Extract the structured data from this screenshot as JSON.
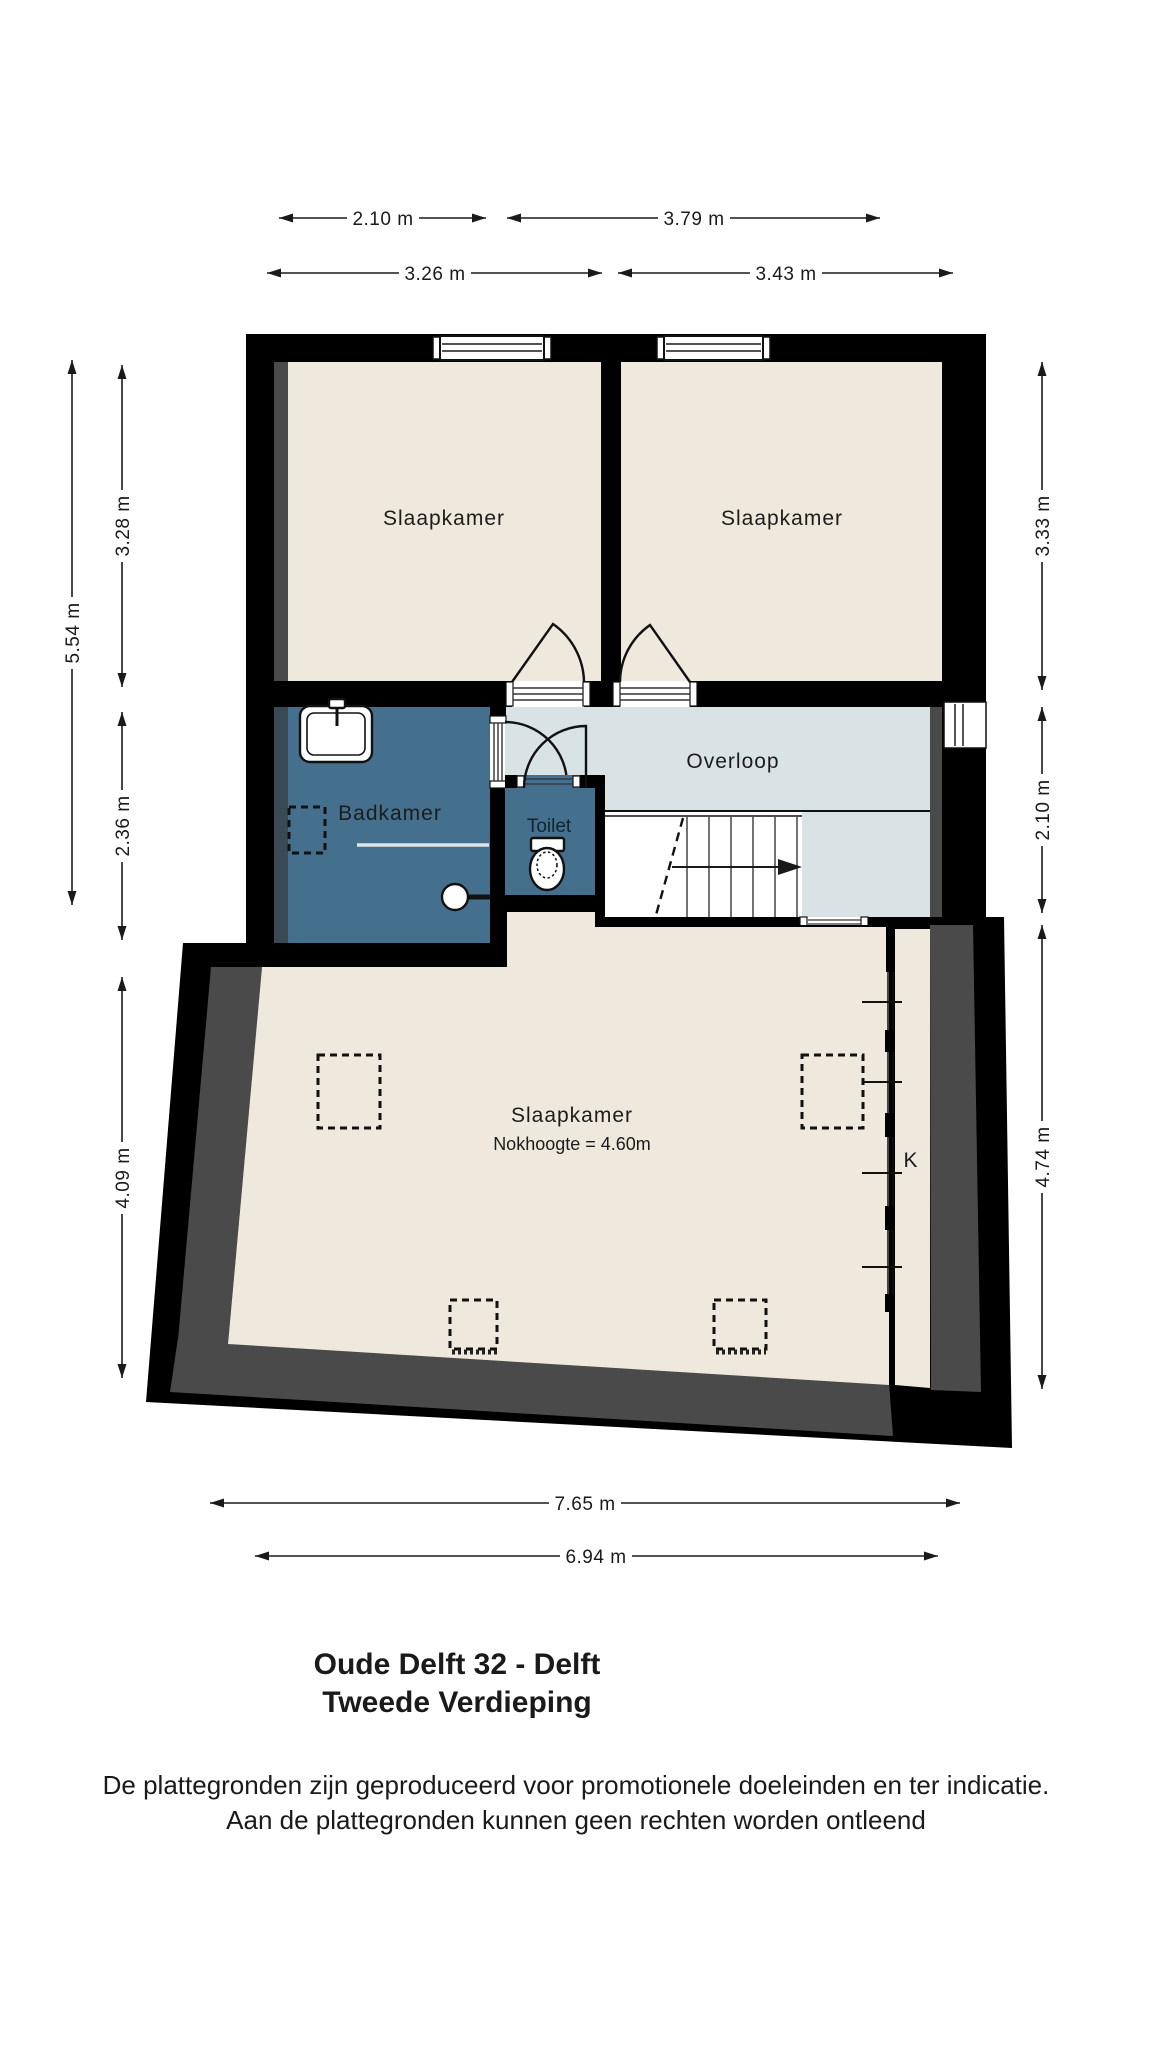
{
  "plan": {
    "rooms": {
      "bedroom_top_left": {
        "label": "Slaapkamer"
      },
      "bedroom_top_right": {
        "label": "Slaapkamer"
      },
      "landing": {
        "label": "Overloop"
      },
      "bathroom": {
        "label": "Badkamer"
      },
      "toilet": {
        "label": "Toilet"
      },
      "bedroom_main": {
        "label": "Slaapkamer",
        "sublabel": "Nokhoogte = 4.60m"
      },
      "closet": {
        "label": "K"
      }
    },
    "dimensions": {
      "top_row1": [
        {
          "label": "2.10 m"
        },
        {
          "label": "3.79 m"
        }
      ],
      "top_row2": [
        {
          "label": "3.26 m"
        },
        {
          "label": "3.43 m"
        }
      ],
      "left": [
        {
          "label": "5.54 m"
        },
        {
          "label": "3.28 m"
        },
        {
          "label": "2.36 m"
        },
        {
          "label": "4.09 m"
        }
      ],
      "right": [
        {
          "label": "3.33 m"
        },
        {
          "label": "2.10 m"
        },
        {
          "label": "4.74 m"
        }
      ],
      "bottom": [
        {
          "label": "7.65 m"
        },
        {
          "label": "6.94 m"
        }
      ]
    },
    "colors": {
      "wall": "#000000",
      "wall_shadow": "#4a4a4a",
      "room_fill": "#efe8dc",
      "bathroom_fill": "#44708e",
      "landing_fill": "#d9e3e5"
    }
  },
  "footer": {
    "title_line1": "Oude Delft 32 - Delft",
    "title_line2": "Tweede Verdieping",
    "disclaimer_line1": "De plattegronden zijn geproduceerd voor promotionele doeleinden en ter indicatie.",
    "disclaimer_line2": "Aan de plattegronden kunnen geen rechten worden ontleend"
  }
}
